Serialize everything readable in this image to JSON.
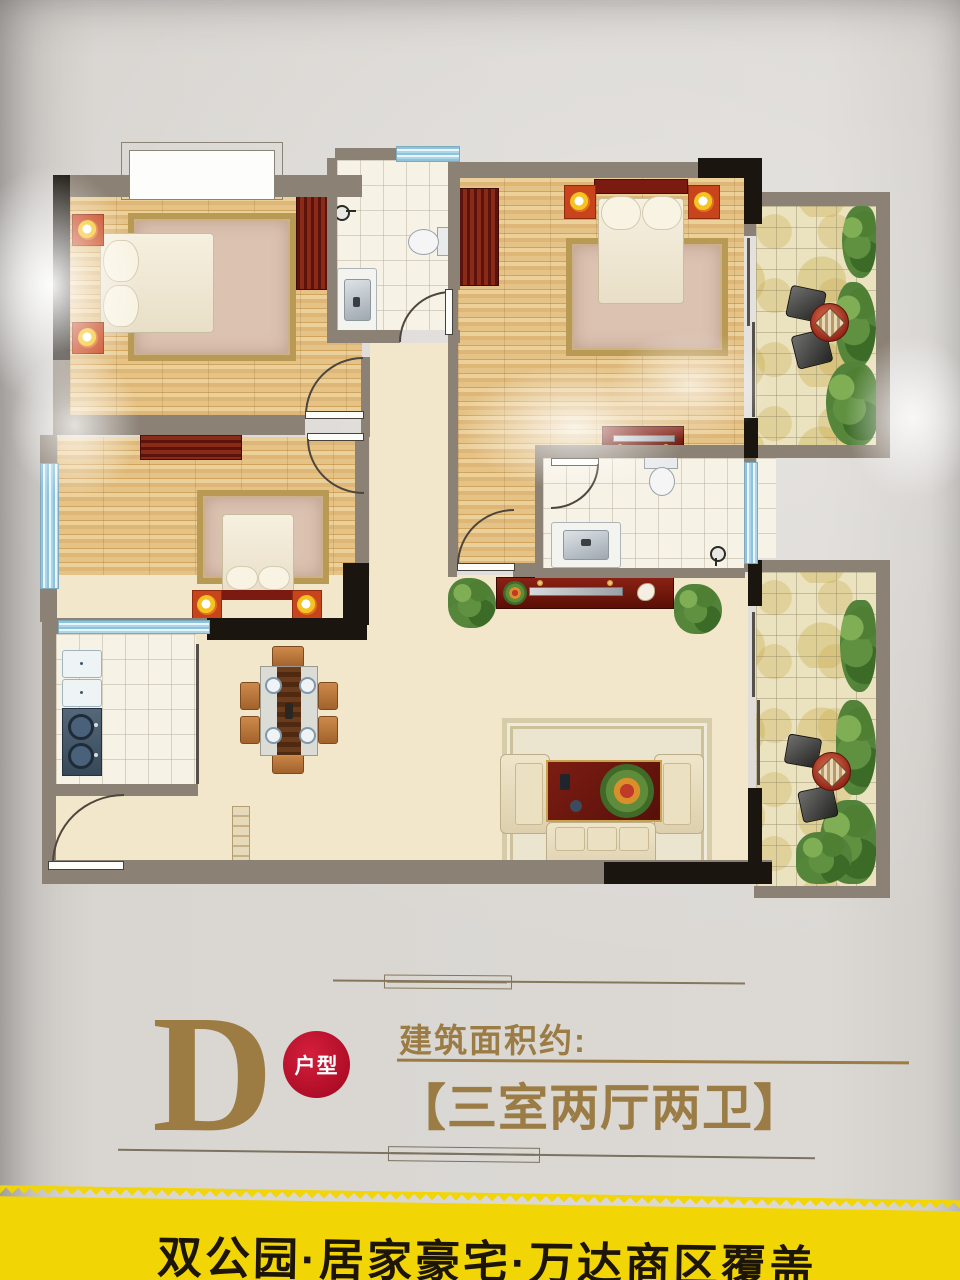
{
  "caption": {
    "type_letter": "D",
    "type_badge": "户型",
    "area_label": "建筑面积约:",
    "layout_text": "【三室两厅两卫】"
  },
  "banner": {
    "slogan": "双公园·居家豪宅·万达商区覆盖"
  },
  "floorplan": {
    "rooms": [
      "bedroom-1",
      "bedroom-2",
      "master-bedroom",
      "bathroom",
      "ensuite-bathroom",
      "kitchen",
      "dining-area",
      "living-room",
      "entry",
      "balcony-top",
      "balcony-bottom",
      "corridor"
    ],
    "furniture_icons": [
      "double-bed-icon",
      "pillow-icon",
      "wardrobe-icon",
      "nightstand-lamp-icon",
      "area-rug-icon",
      "toilet-icon",
      "sink-vanity-icon",
      "shower-head-icon",
      "kitchen-sink-icon",
      "gas-stove-icon",
      "dining-table-icon",
      "dining-chair-icon",
      "plate-icon",
      "sofa-icon",
      "armchair-icon",
      "coffee-table-icon",
      "flower-bouquet-icon",
      "tv-cabinet-icon",
      "potted-plant-icon",
      "balcony-chair-icon",
      "balcony-table-icon",
      "door-swing-icon",
      "sliding-door-icon",
      "window-icon",
      "bay-window-icon"
    ]
  },
  "colors": {
    "accent_gold": "#9b7c44",
    "badge_red": "#ad0c26",
    "banner_yellow": "#f2d504",
    "banner_text": "#1c1508",
    "wall_gray": "#8b8174",
    "wall_black": "#1a150f",
    "wood_floor": "#ddb678",
    "cream_floor": "#f2e7ca",
    "tile_white": "#f7f2e6",
    "balcony_tile": "#ebe2bf",
    "window_blue": "#a9d6ea",
    "furniture_dark_red": "#70190f"
  }
}
